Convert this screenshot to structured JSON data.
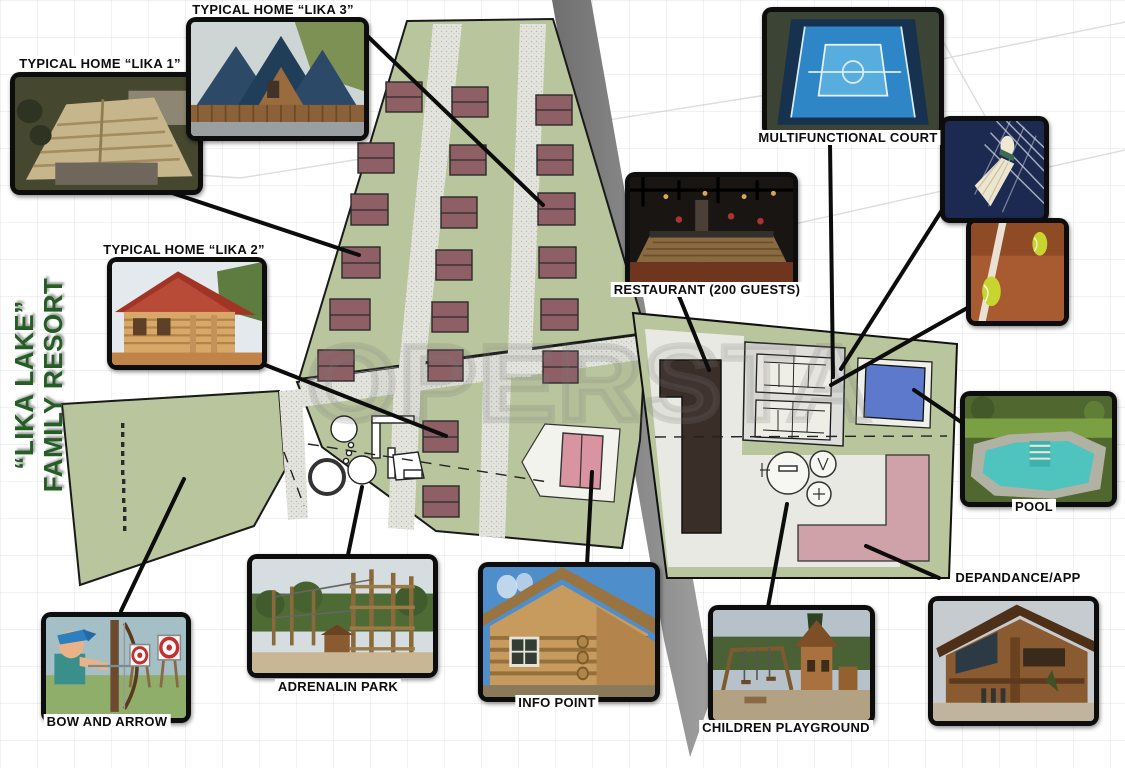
{
  "poster": {
    "title_line1": "“LIKA LAKE”",
    "title_line2": "FAMILY RESORT",
    "title_color": "#245e24",
    "watermark": "OPERSTA"
  },
  "callouts": {
    "lika1": {
      "label": "TYPICAL HOME “LIKA 1”",
      "photo": "aerial view of wooden shingle-roof home"
    },
    "lika3": {
      "label": "TYPICAL HOME “LIKA 3”",
      "photo": "a-frame homes with blue roofs"
    },
    "lika2": {
      "label": "TYPICAL HOME “LIKA 2”",
      "photo": "log home with red gable roof"
    },
    "court": {
      "label": "MULTIFUNCTIONAL COURT",
      "photo": "aerial blue multisport court"
    },
    "restaurant": {
      "label": "RESTAURANT (200 GUESTS)",
      "photo": "restaurant interior with wooden buffet counter"
    },
    "pool": {
      "label": "POOL",
      "photo": "natural garden pool with stone edge"
    },
    "depandance": {
      "label": "DEPANDANCE/APP",
      "photo": "large timber apartment house"
    },
    "playground": {
      "label": "CHILDREN PLAYGROUND",
      "photo": "wooden playground tower and swings"
    },
    "infopoint": {
      "label": "INFO POINT",
      "photo": "log cabin info office"
    },
    "adrenalin": {
      "label": "ADRENALIN PARK",
      "photo": "high-ropes wooden adventure towers"
    },
    "bowarrow": {
      "label": "BOW AND ARROW",
      "photo": "cartoon archer shooting at targets"
    },
    "badminton": {
      "photo": "badminton shuttlecock on net"
    },
    "tennis": {
      "photo": "tennis balls on clay court"
    }
  },
  "plan": {
    "green_area_color": "#b9c59c",
    "gravel_path_color": "#e4e4de",
    "road_color": "#8c8c8c",
    "home_footprint_color": "#8e6065",
    "home_footprints": 20,
    "restaurant_building_color": "#3a2e29",
    "pool_color": "#5c79cb",
    "depandance_building_color": "#cfa2aa",
    "info_point_building_color": "#d994a1"
  }
}
